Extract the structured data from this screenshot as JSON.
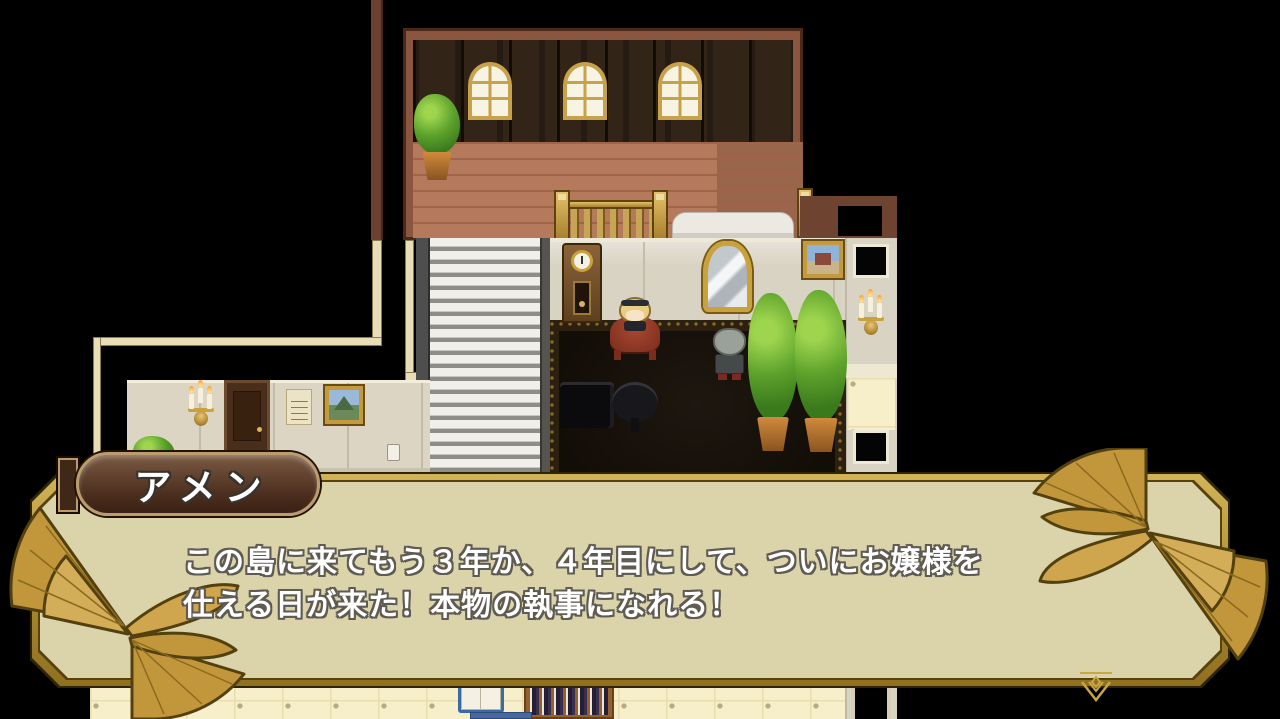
{
  "game": {
    "name_tag": "アメン",
    "dialogue": {
      "line1": "この島に来てもう３年か、４年目にして、ついにお嬢様を",
      "line2": "仕える日が来た！本物の執事になれる！"
    }
  },
  "icons": {
    "left_ornament": "golden-fan-palmette-ornament",
    "right_ornament": "golden-fan-palmette-ornament",
    "pause_cursor": "advance-indicator-double-chevron-down"
  },
  "colors": {
    "window_border_gold": "#b3922e",
    "window_fill": "rgba(253,247,208,0.80)",
    "name_box_brown": "#4a2d1d",
    "name_box_trim": "#bb9c6e",
    "text_white": "#ffffff",
    "text_outline": "#5f5b53",
    "ornament_gold": "#c2963a"
  },
  "scene": {
    "description": "mansion interior map",
    "objects": [
      "arched-windows",
      "potted-plants",
      "balcony-railing",
      "white-sofa",
      "grandfather-clock",
      "gold-mirror",
      "paintings",
      "wall-sconces",
      "stairs",
      "dark-carpet-room",
      "piano",
      "round-table",
      "maid-npc-at-red-table",
      "butler-npc",
      "hall-door",
      "notice-poster",
      "wall-outlet",
      "bookshelf",
      "open-book",
      "side-doorways"
    ]
  }
}
